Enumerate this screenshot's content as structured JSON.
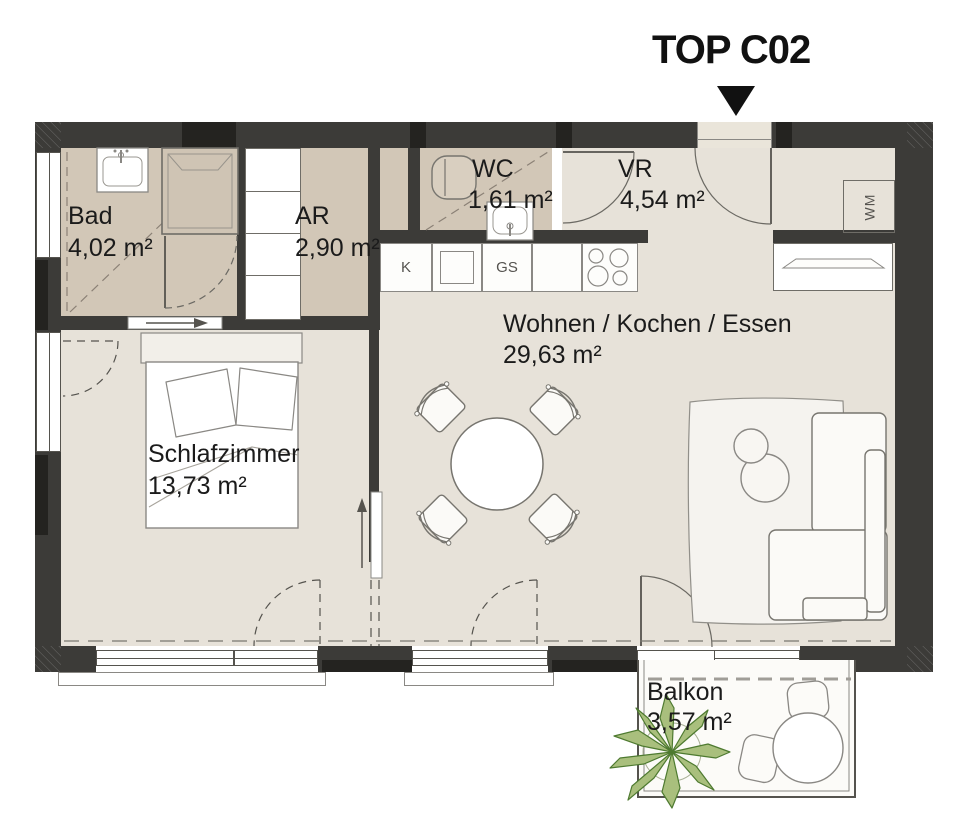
{
  "unit": {
    "title": "TOP C02"
  },
  "rooms": {
    "bad": {
      "name": "Bad",
      "area": "4,02 m²"
    },
    "ar": {
      "name": "AR",
      "area": "2,90 m²"
    },
    "wc": {
      "name": "WC",
      "area": "1,61 m²"
    },
    "vr": {
      "name": "VR",
      "area": "4,54 m²"
    },
    "wohnen": {
      "name": "Wohnen / Kochen / Essen",
      "area": "29,63 m²"
    },
    "schlafzimmer": {
      "name": "Schlafzimmer",
      "area": "13,73 m²"
    },
    "balkon": {
      "name": "Balkon",
      "area": "3,57 m²"
    }
  },
  "appliances": {
    "fridge": "K",
    "dishwasher": "GS",
    "washing_machine": "WM"
  },
  "colors": {
    "wall": "#3c3b38",
    "floor_main": "#e7e2d9",
    "floor_wet": "#d2c7b7",
    "entrance_niche": "#eae5da",
    "plant_green": "#a9bf7d",
    "line": "#7b7974"
  }
}
